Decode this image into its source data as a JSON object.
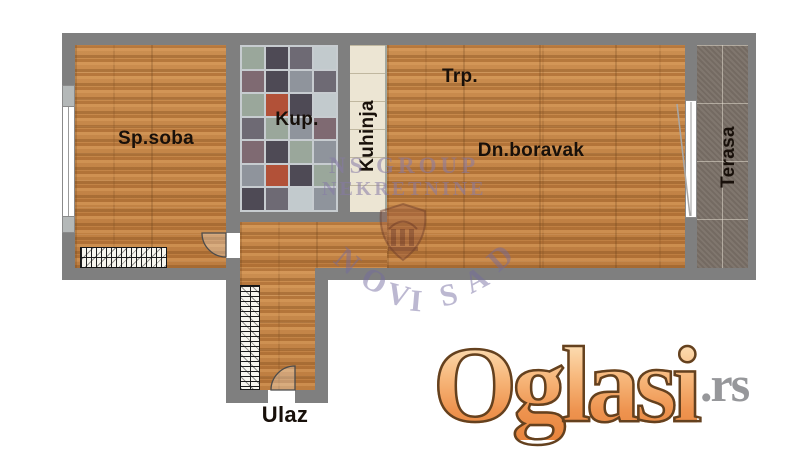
{
  "plan": {
    "rooms": {
      "bedroom": "Sp.soba",
      "bathroom": "Kup.",
      "kitchen": "Kuhinja",
      "dining": "Trp.",
      "living": "Dn.boravak",
      "terrace": "Terasa",
      "entrance": "Ulaz"
    },
    "colors": {
      "wall": "#7f7f7f",
      "wood": "#c6864a",
      "kitchen_tile": "#ece5d3",
      "terrace_tile": "#7b7168",
      "bathroom_palette": [
        "#4e4a55",
        "#6e6a74",
        "#8f949c",
        "#9aa79b",
        "#c2cacd",
        "#7f6a72",
        "#b25138"
      ]
    }
  },
  "watermark": {
    "line1": "NS GROUP",
    "line2": "NEKRETNINE",
    "city": "NOVI SAD"
  },
  "logo": {
    "name": "Oglasi",
    "tld": ".rs"
  }
}
